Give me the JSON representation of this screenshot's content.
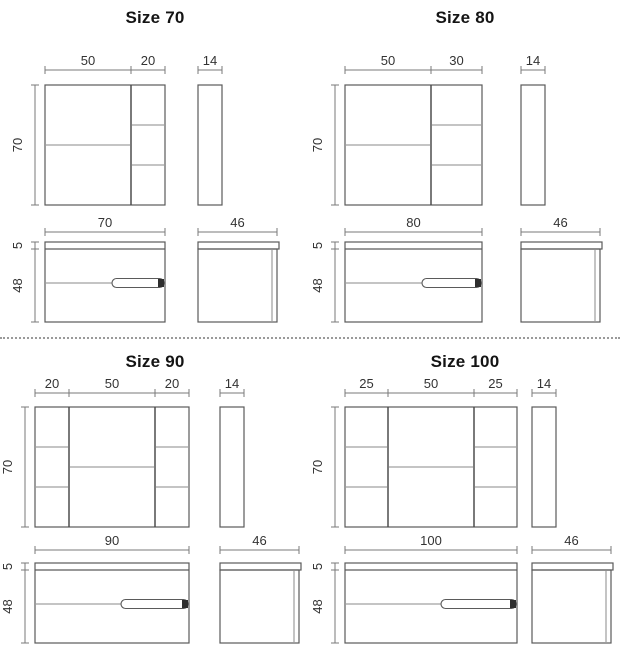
{
  "colors": {
    "outline": "#5a5a5a",
    "divider_line": "#4d4d4d",
    "shelf_line": "#8a8a8a",
    "dimension_line": "#7a7a7a",
    "text": "#333333",
    "handle_cap": "#2e2e2e",
    "separator_dots": "#9a9a9a"
  },
  "panels": [
    {
      "title": "Size 70",
      "mirror": {
        "height": 70,
        "depth": 14,
        "sections": [
          {
            "width": 50,
            "shelf_lines": 1
          },
          {
            "width": 20,
            "shelf_lines": 2
          }
        ]
      },
      "vanity": {
        "width": 70,
        "counter_height": 5,
        "body_height": 48,
        "depth": 46
      }
    },
    {
      "title": "Size 80",
      "mirror": {
        "height": 70,
        "depth": 14,
        "sections": [
          {
            "width": 50,
            "shelf_lines": 1
          },
          {
            "width": 30,
            "shelf_lines": 2
          }
        ]
      },
      "vanity": {
        "width": 80,
        "counter_height": 5,
        "body_height": 48,
        "depth": 46
      }
    },
    {
      "title": "Size 90",
      "mirror": {
        "height": 70,
        "depth": 14,
        "sections": [
          {
            "width": 20,
            "shelf_lines": 2
          },
          {
            "width": 50,
            "shelf_lines": 1
          },
          {
            "width": 20,
            "shelf_lines": 2
          }
        ]
      },
      "vanity": {
        "width": 90,
        "counter_height": 5,
        "body_height": 48,
        "depth": 46
      }
    },
    {
      "title": "Size 100",
      "mirror": {
        "height": 70,
        "depth": 14,
        "sections": [
          {
            "width": 25,
            "shelf_lines": 2
          },
          {
            "width": 50,
            "shelf_lines": 1
          },
          {
            "width": 25,
            "shelf_lines": 2
          }
        ]
      },
      "vanity": {
        "width": 100,
        "counter_height": 5,
        "body_height": 48,
        "depth": 46
      }
    }
  ]
}
